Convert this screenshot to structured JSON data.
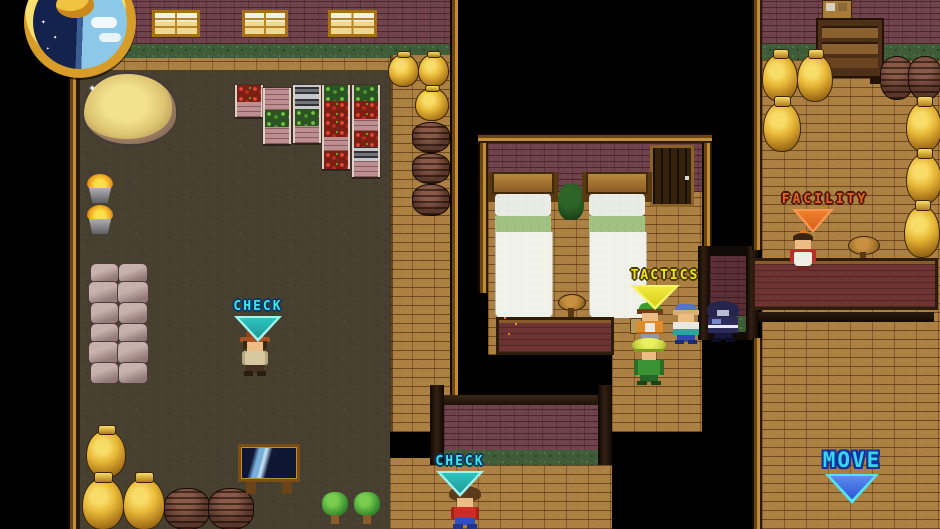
{
  "markers": {
    "check_left": {
      "label": "CHECK"
    },
    "tactics": {
      "label": "TACTICS"
    },
    "facility": {
      "label": "FACILITY"
    },
    "check_bottom": {
      "label": "CHECK"
    },
    "move": {
      "label": "MOVE"
    }
  },
  "hud": {
    "clock_icon": "day-night-disc"
  },
  "scene": {
    "style": "overhead pixel-art inn/village interior",
    "left_room_objects": [
      "haystack",
      "fire-basket",
      "produce-shelves",
      "grain-sack-pile",
      "gold-urn",
      "barrel",
      "signboard",
      "plant"
    ],
    "bedroom_objects": [
      "bed",
      "bed",
      "door",
      "stool",
      "counter",
      "flower-plant"
    ],
    "right_room_objects": [
      "cabinet",
      "gold-urn",
      "barrel",
      "stool",
      "counter"
    ]
  },
  "colors": {
    "check-text": "#3CE8E0",
    "check-outline": "#0C3468",
    "tactics-text": "#EEE41C",
    "tactics-outline": "#4A3A00",
    "facility-text": "#E0641C",
    "facility-outline": "#50180A",
    "move-text": "#38D4E8",
    "move-outline": "#1030A0",
    "tri-cyan-border": "#A0F4EE",
    "tri-cyan-fill": "#2CC4C0",
    "tri-yellow-border": "#F8F468",
    "tri-yellow-fill": "#D8CC14",
    "tri-orange-border": "#F89850",
    "tri-orange-fill": "#D85E18",
    "tri-blue-border": "#54E4F0",
    "tri-blue-fill": "#2F55D8"
  }
}
